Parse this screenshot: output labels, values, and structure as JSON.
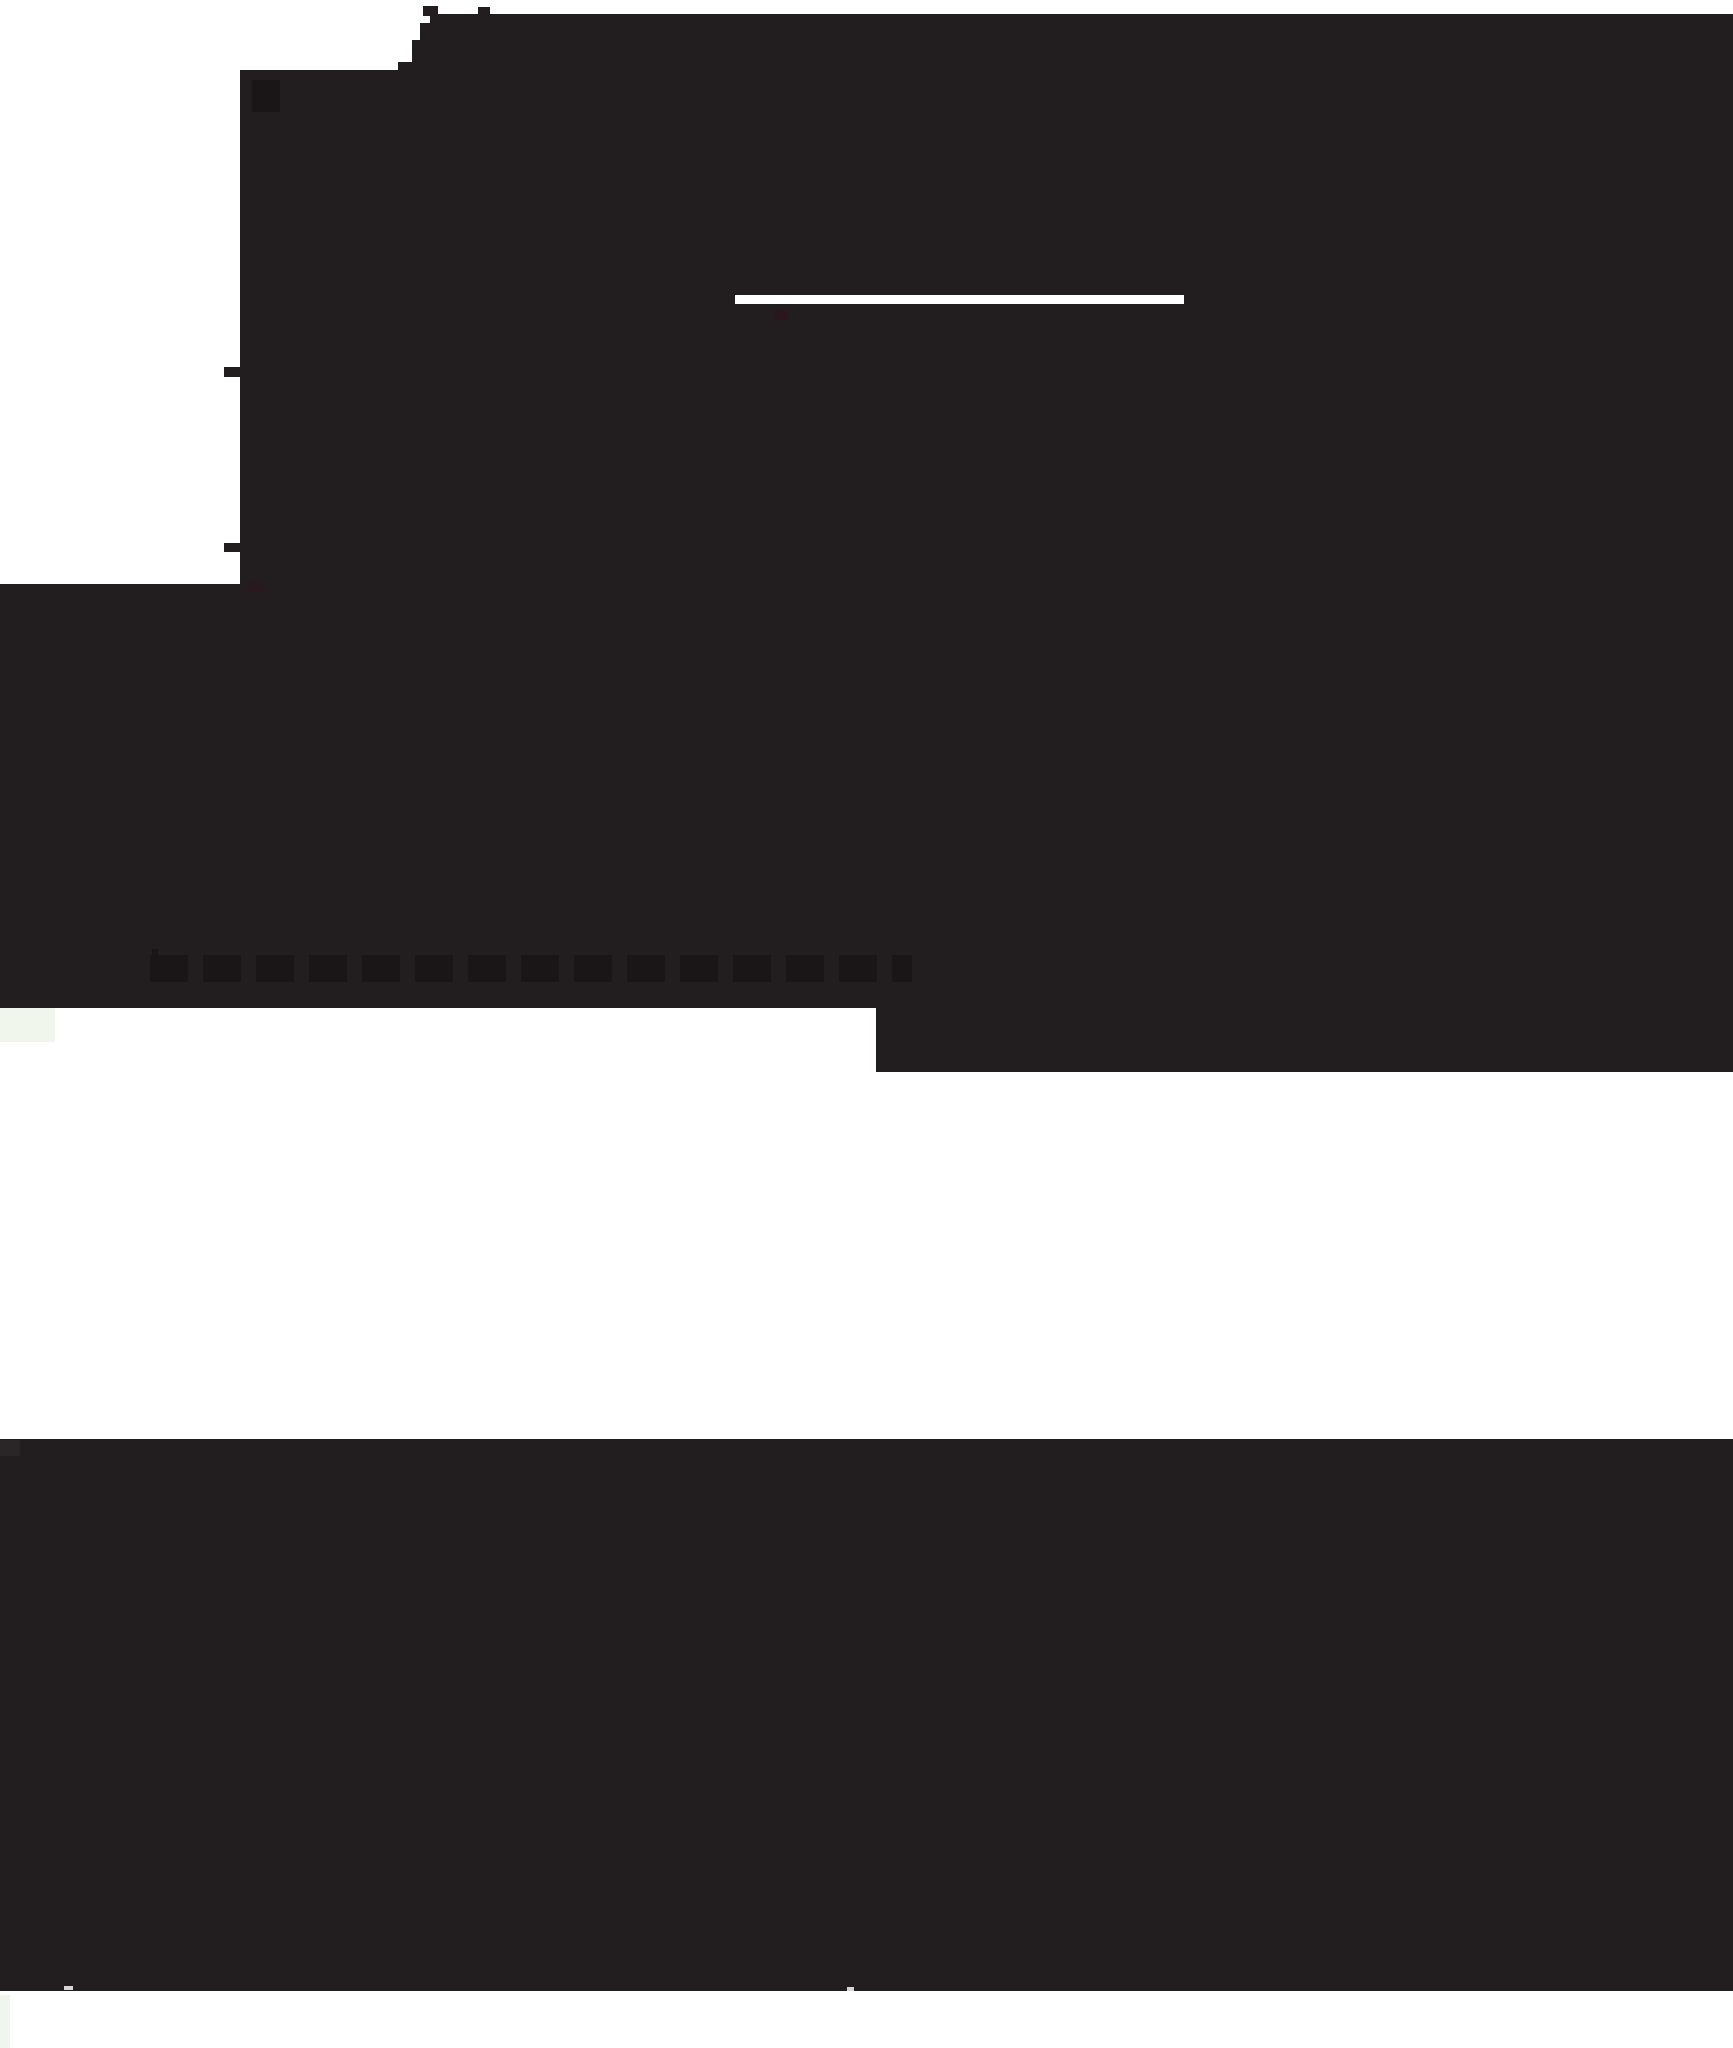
{
  "meta": {
    "width": 1733,
    "height": 2048
  },
  "colors": {
    "ink": "#221e1f",
    "ghost": "#1a1617",
    "chip": "#2a2527",
    "paper": "#ffffff",
    "dash": "#d9d5d6",
    "red": "#321219",
    "palegreen": "#f0f6ec"
  },
  "shapes": [
    {
      "name": "hero-block-main",
      "x": 240,
      "y": 70,
      "w": 1493,
      "h": 938,
      "fill": "ink"
    },
    {
      "name": "hero-step-1",
      "x": 398,
      "y": 62,
      "w": 1335,
      "h": 9,
      "fill": "ink"
    },
    {
      "name": "hero-step-2",
      "x": 412,
      "y": 40,
      "w": 1321,
      "h": 23,
      "fill": "ink"
    },
    {
      "name": "hero-step-3",
      "x": 420,
      "y": 23,
      "w": 1313,
      "h": 18,
      "fill": "ink"
    },
    {
      "name": "hero-step-4",
      "x": 430,
      "y": 14,
      "w": 1303,
      "h": 10,
      "fill": "ink"
    },
    {
      "name": "hero-tab-1",
      "x": 423,
      "y": 6,
      "w": 15,
      "h": 10,
      "fill": "ink"
    },
    {
      "name": "hero-tab-2",
      "x": 478,
      "y": 7,
      "w": 12,
      "h": 9,
      "fill": "ink"
    },
    {
      "name": "hero-left-flood",
      "x": 0,
      "y": 584,
      "w": 240,
      "h": 424,
      "fill": "ink"
    },
    {
      "name": "hero-bottom-right-extension",
      "x": 876,
      "y": 1006,
      "w": 857,
      "h": 66,
      "fill": "ink"
    },
    {
      "name": "left-tick-1",
      "x": 224,
      "y": 367,
      "w": 16,
      "h": 10,
      "fill": "ink"
    },
    {
      "name": "left-tick-2",
      "x": 224,
      "y": 543,
      "w": 16,
      "h": 9,
      "fill": "ink"
    },
    {
      "name": "hero-glyph-artifact",
      "x": 252,
      "y": 80,
      "w": 28,
      "h": 32,
      "fill": "ghost"
    },
    {
      "name": "ghost-text-row",
      "x": 150,
      "y": 955,
      "w": 762,
      "h": 27,
      "fill": "ghost",
      "pattern": "dashes"
    },
    {
      "name": "ghost-text-row-cap",
      "x": 152,
      "y": 949,
      "w": 6,
      "h": 33,
      "fill": "ghost"
    },
    {
      "name": "divider-line",
      "x": 735,
      "y": 295,
      "w": 449,
      "h": 9,
      "fill": "paper"
    },
    {
      "name": "red-artifact-dot",
      "x": 773,
      "y": 310,
      "w": 16,
      "h": 10,
      "fill": "red",
      "opacity": 0.55,
      "radius": 5
    },
    {
      "name": "red-artifact-corner",
      "x": 247,
      "y": 582,
      "w": 16,
      "h": 11,
      "fill": "red",
      "opacity": 0.45,
      "radius": 5
    },
    {
      "name": "ghost-logo",
      "x": 0,
      "y": 1008,
      "w": 55,
      "h": 34,
      "fill": "palegreen"
    },
    {
      "name": "footer-band",
      "x": 0,
      "y": 1439,
      "w": 1733,
      "h": 552,
      "fill": "ink"
    },
    {
      "name": "footer-chip",
      "x": 0,
      "y": 1440,
      "w": 20,
      "h": 16,
      "fill": "chip"
    },
    {
      "name": "footer-dash-left",
      "x": 64,
      "y": 1986,
      "w": 9,
      "h": 4,
      "fill": "dash"
    },
    {
      "name": "footer-dot-right",
      "x": 847,
      "y": 1987,
      "w": 7,
      "h": 4,
      "fill": "dash"
    },
    {
      "name": "left-edge-speckle",
      "x": 0,
      "y": 1995,
      "w": 10,
      "h": 53,
      "fill": "palegreen"
    }
  ]
}
